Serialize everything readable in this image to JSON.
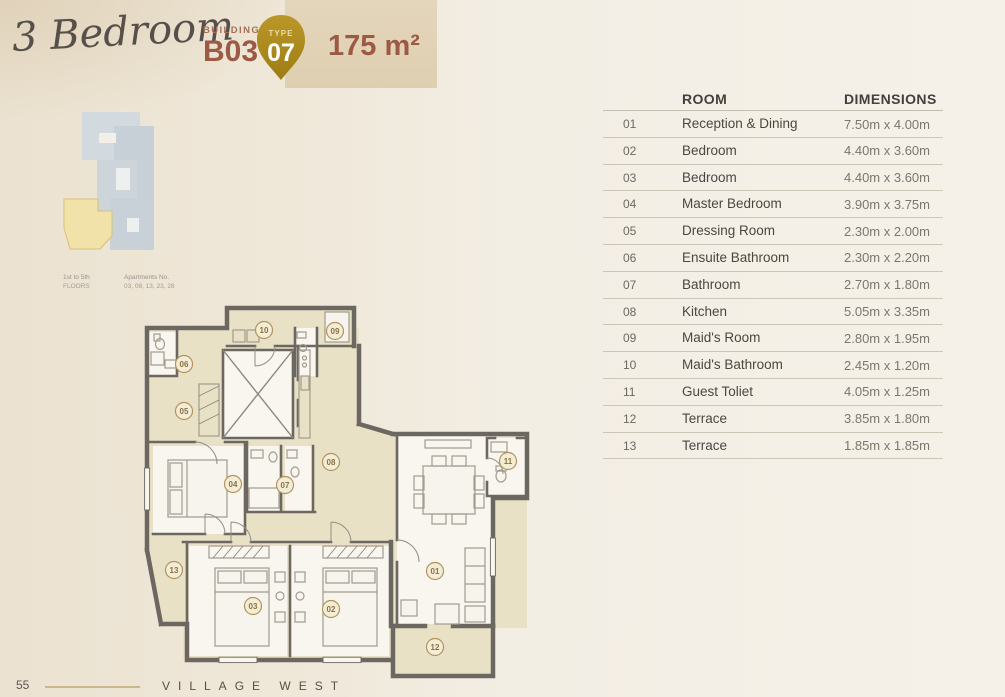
{
  "header": {
    "title_script": "3 Bedroom",
    "building_label": "BUILDING",
    "building_value": "B03",
    "type_label": "TYPE",
    "type_value": "07",
    "area": "175 m²",
    "accent_color": "#9c5a45",
    "badge_gold": "#ae8b20"
  },
  "keyplan": {
    "floors_line1": "1st to 5th",
    "floors_line2": "FLOORS",
    "apartments_line1": "Apartments No.",
    "apartments_line2": "03, 08, 13, 23, 28",
    "highlight_color": "#f1e2a9",
    "footprint_color": "#ccd4db"
  },
  "table": {
    "headers": {
      "room": "ROOM",
      "dimensions": "DIMENSIONS"
    },
    "rows": [
      {
        "num": "01",
        "room": "Reception & Dining",
        "dim": "7.50m x 4.00m"
      },
      {
        "num": "02",
        "room": "Bedroom",
        "dim": "4.40m x 3.60m"
      },
      {
        "num": "03",
        "room": "Bedroom",
        "dim": "4.40m x 3.60m"
      },
      {
        "num": "04",
        "room": "Master Bedroom",
        "dim": "3.90m x 3.75m"
      },
      {
        "num": "05",
        "room": "Dressing Room",
        "dim": "2.30m x 2.00m"
      },
      {
        "num": "06",
        "room": "Ensuite Bathroom",
        "dim": "2.30m x 2.20m"
      },
      {
        "num": "07",
        "room": "Bathroom",
        "dim": "2.70m x 1.80m"
      },
      {
        "num": "08",
        "room": "Kitchen",
        "dim": "5.05m x 3.35m"
      },
      {
        "num": "09",
        "room": "Maid's Room",
        "dim": "2.80m x 1.95m"
      },
      {
        "num": "10",
        "room": "Maid's Bathroom",
        "dim": "2.45m x 1.20m"
      },
      {
        "num": "11",
        "room": "Guest Toliet",
        "dim": "4.05m x 1.25m"
      },
      {
        "num": "12",
        "room": "Terrace",
        "dim": "3.85m x 1.80m"
      },
      {
        "num": "13",
        "room": "Terrace",
        "dim": "1.85m x 1.85m"
      }
    ]
  },
  "floorplan": {
    "labels": [
      {
        "n": "10",
        "x": 129,
        "y": 30
      },
      {
        "n": "09",
        "x": 200,
        "y": 31
      },
      {
        "n": "06",
        "x": 49,
        "y": 64
      },
      {
        "n": "05",
        "x": 49,
        "y": 111
      },
      {
        "n": "08",
        "x": 196,
        "y": 162
      },
      {
        "n": "04",
        "x": 98,
        "y": 184
      },
      {
        "n": "07",
        "x": 150,
        "y": 185
      },
      {
        "n": "11",
        "x": 373,
        "y": 161
      },
      {
        "n": "01",
        "x": 300,
        "y": 271
      },
      {
        "n": "13",
        "x": 39,
        "y": 270
      },
      {
        "n": "03",
        "x": 118,
        "y": 306
      },
      {
        "n": "02",
        "x": 196,
        "y": 309
      },
      {
        "n": "12",
        "x": 300,
        "y": 347
      }
    ]
  },
  "footer": {
    "page_number": "55",
    "brand": "VILLAGE WEST"
  }
}
